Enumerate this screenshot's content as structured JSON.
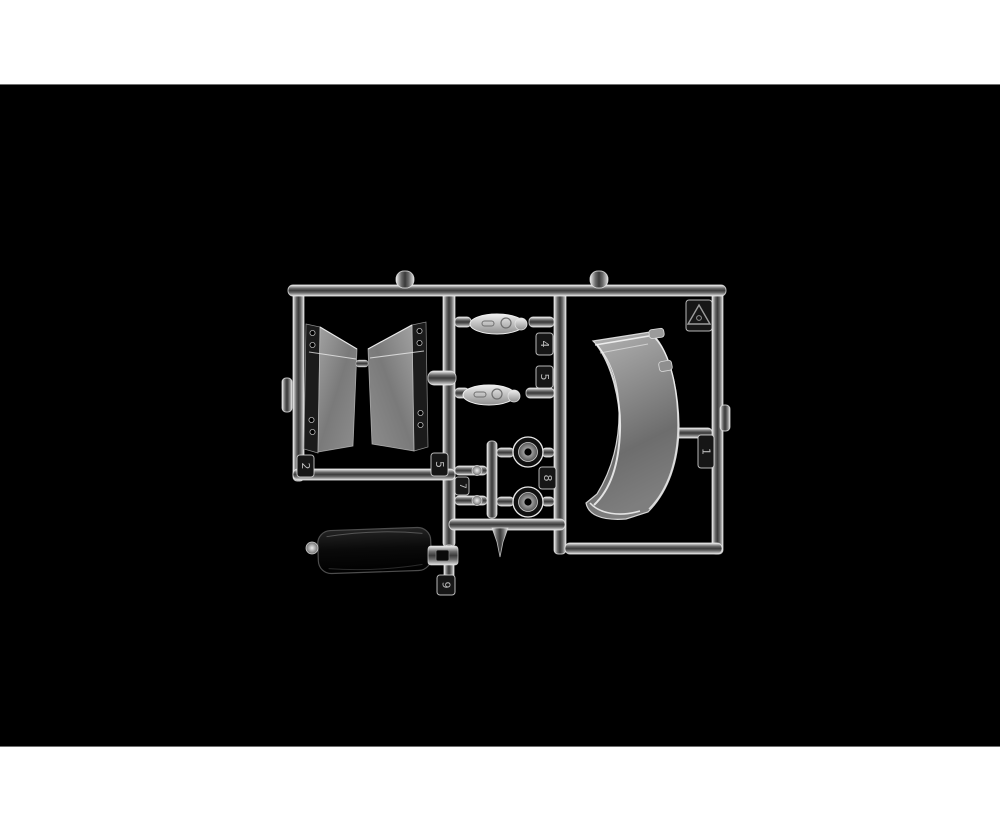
{
  "photo": {
    "description": "Clear transparent plastic model-kit sprue (clear parts tree) with a curved windscreen, two wind deflector panels, oval and round lamp lenses and a dark smoked screen, photographed on a black background",
    "page_background_color": "#ffffff",
    "photo_background_color": "#000000",
    "plastic_highlight_color": "#e9e9e9",
    "smoked_part_tint": "#8a8a8a",
    "dark_part_color": "#0c0c0c"
  },
  "sprue": {
    "part_number_tags": {
      "tag_1": "1",
      "tag_2": "2",
      "tag_4": "4",
      "tag_5_frame": "5",
      "tag_5_rail": "5",
      "tag_7": "7",
      "tag_8": "8",
      "tag_9": "9"
    }
  }
}
